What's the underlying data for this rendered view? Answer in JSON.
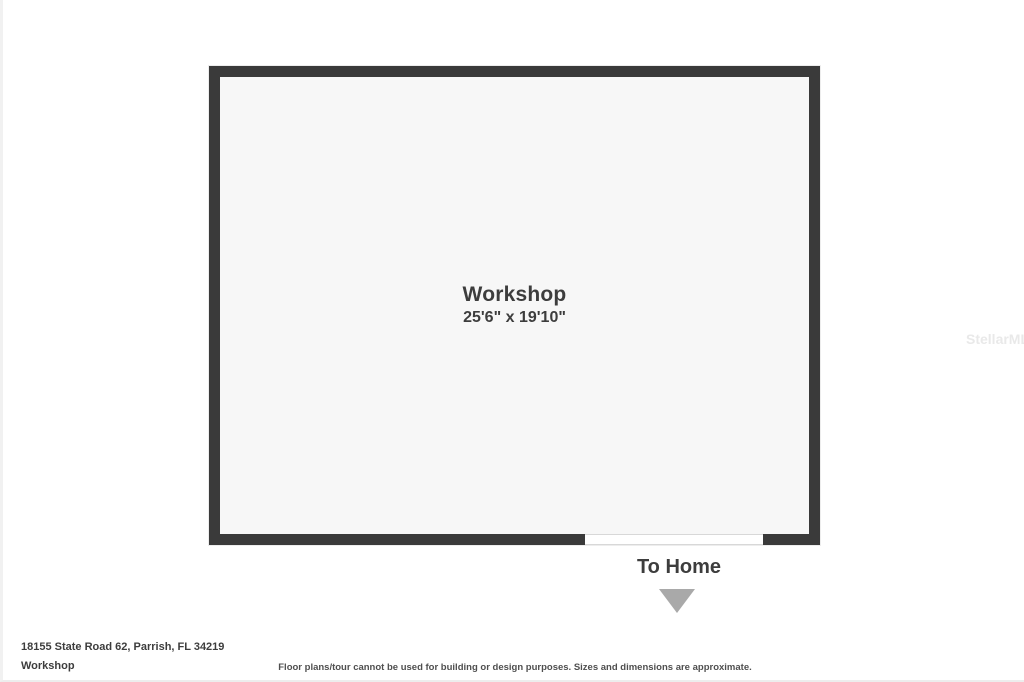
{
  "plan": {
    "room": {
      "name": "Workshop",
      "dimensions": "25'6\" x 19'10\""
    },
    "exit": {
      "label": "To Home",
      "arrow_icon": "triangle-down-icon"
    }
  },
  "watermark": "StellarMLS",
  "footer": {
    "address": "18155 State Road 62, Parrish, FL 34219",
    "plan_title": "Workshop",
    "disclaimer": "Floor plans/tour cannot be used for building or design purposes. Sizes and dimensions are approximate."
  },
  "colors": {
    "wall": "#3a3a3a",
    "room_fill": "#f7f7f7",
    "label_text": "#3d3d3d",
    "arrow": "#a9a9a9",
    "watermark_text": "#e9e9e9",
    "disclaimer_text": "#4f4f4f"
  }
}
